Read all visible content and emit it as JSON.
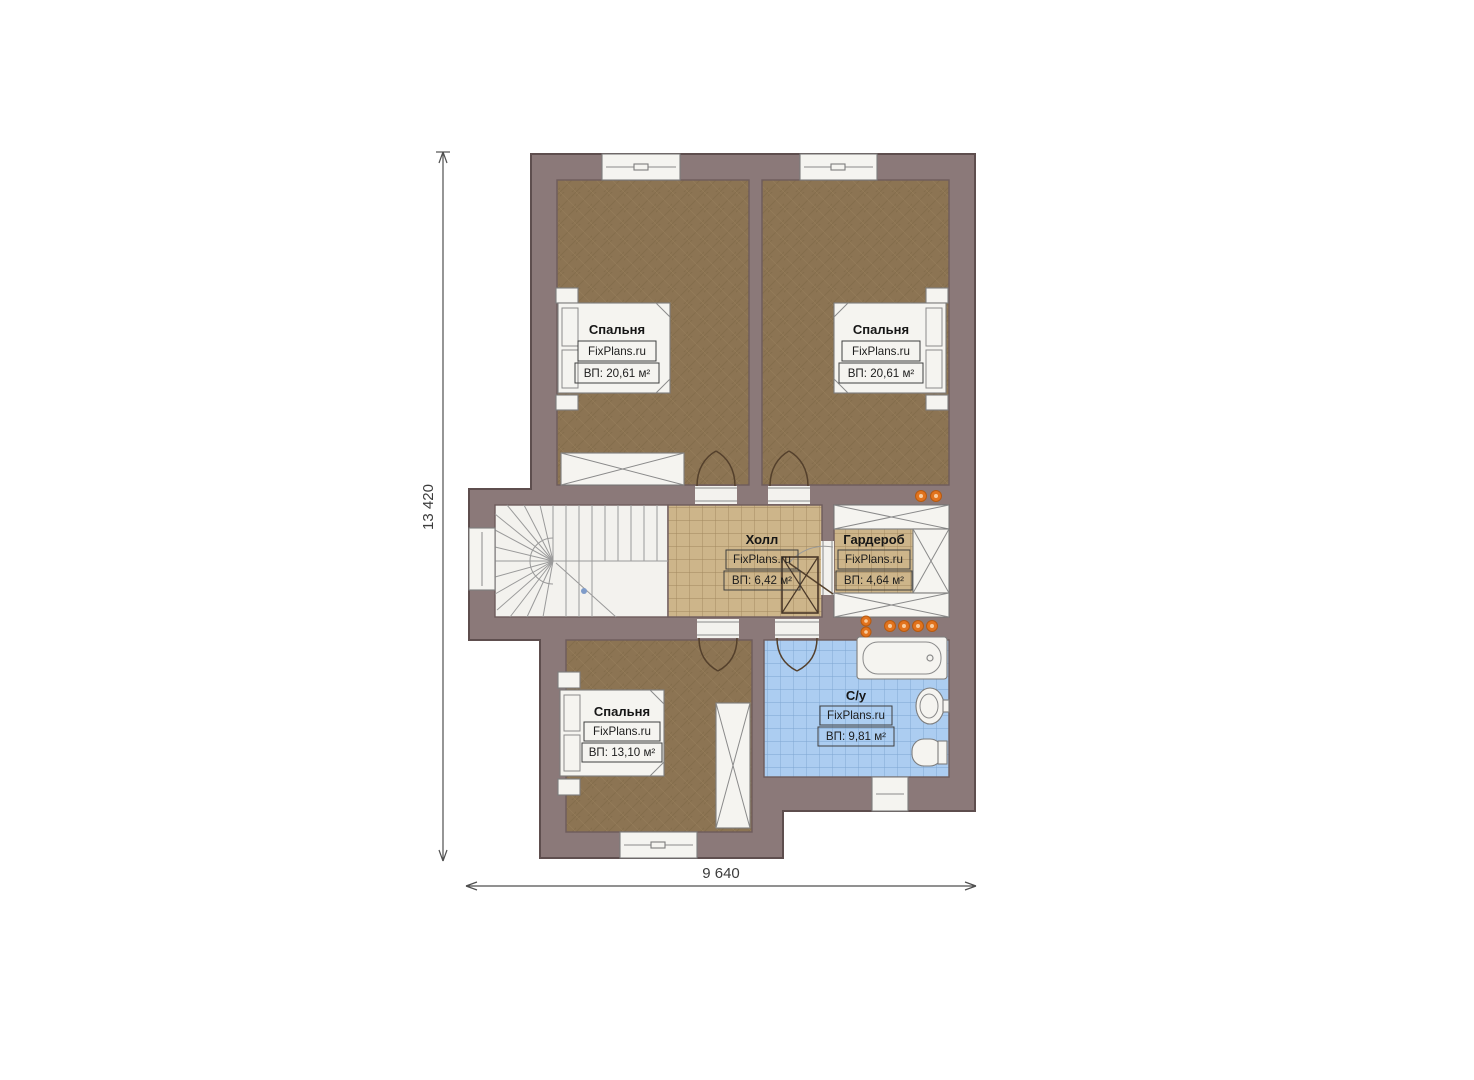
{
  "plan": {
    "dimension_vertical": "13 420",
    "dimension_horizontal": "9 640",
    "rooms": [
      {
        "id": "bedroom-top-left",
        "name": "Спальня",
        "brand": "FixPlans.ru",
        "area": "ВП: 20,61 м²"
      },
      {
        "id": "bedroom-top-right",
        "name": "Спальня",
        "brand": "FixPlans.ru",
        "area": "ВП: 20,61 м²"
      },
      {
        "id": "hall",
        "name": "Холл",
        "brand": "FixPlans.ru",
        "area": "ВП: 6,42 м²"
      },
      {
        "id": "wardrobe",
        "name": "Гардероб",
        "brand": "FixPlans.ru",
        "area": "ВП: 4,64 м²"
      },
      {
        "id": "bedroom-bottom",
        "name": "Спальня",
        "brand": "FixPlans.ru",
        "area": "ВП: 13,10 м²"
      },
      {
        "id": "bathroom",
        "name": "С/у",
        "brand": "FixPlans.ru",
        "area": "ВП: 9,81 м²"
      }
    ],
    "colors": {
      "wall": "#8b7979",
      "bedroom_floor": "#8c7453",
      "hall_tile": "#cdb58a",
      "bath_tile": "#accdf1",
      "fixture_white": "#f5f4f0",
      "ceiling_light": "#e2731d"
    }
  }
}
